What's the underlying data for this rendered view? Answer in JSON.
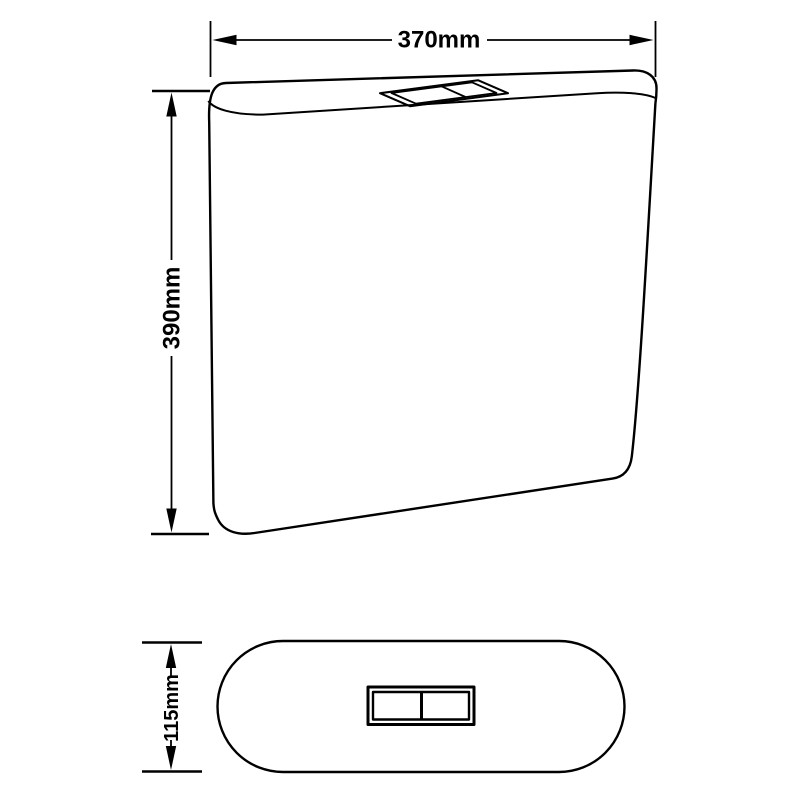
{
  "canvas": {
    "background_color": "#ffffff",
    "line_color": "#000000"
  },
  "front_view": {
    "width_dimension_label": "370mm",
    "height_dimension_label": "390mm"
  },
  "plan_view": {
    "depth_dimension_label": "115mm"
  }
}
